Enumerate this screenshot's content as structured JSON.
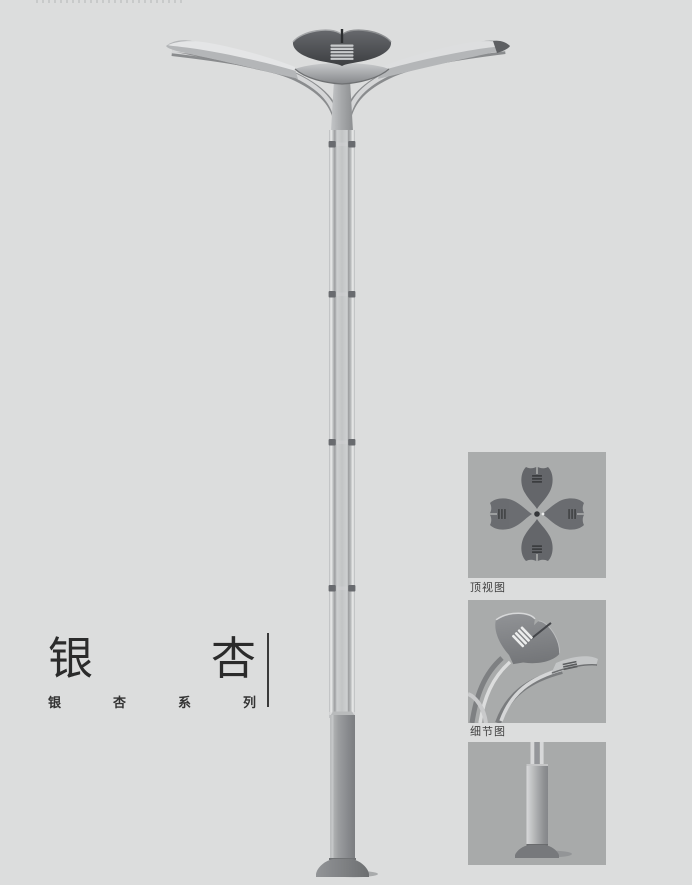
{
  "page": {
    "background_color": "#dcdddd"
  },
  "title_block": {
    "main_title_chars": [
      "银",
      "杏"
    ],
    "subtitle_chars": [
      "银",
      "杏",
      "系",
      "列"
    ],
    "divider_color": "#3a3a3a",
    "text_color": "#2b2b2b"
  },
  "main_illustration": {
    "name": "ginkgo-double-arm-street-lamp",
    "metal_light": "#d8d9da",
    "metal_mid": "#aaacae",
    "head_dark": "#3c3e41"
  },
  "detail_panels": [
    {
      "caption": "顶视图",
      "image_name": "lamp-top-view",
      "background": "#aaacac"
    },
    {
      "caption": "细节图",
      "image_name": "lamp-head-detail",
      "background": "#a9abab"
    },
    {
      "caption": "",
      "image_name": "pole-base-detail",
      "background": "#a8aaaa"
    }
  ]
}
